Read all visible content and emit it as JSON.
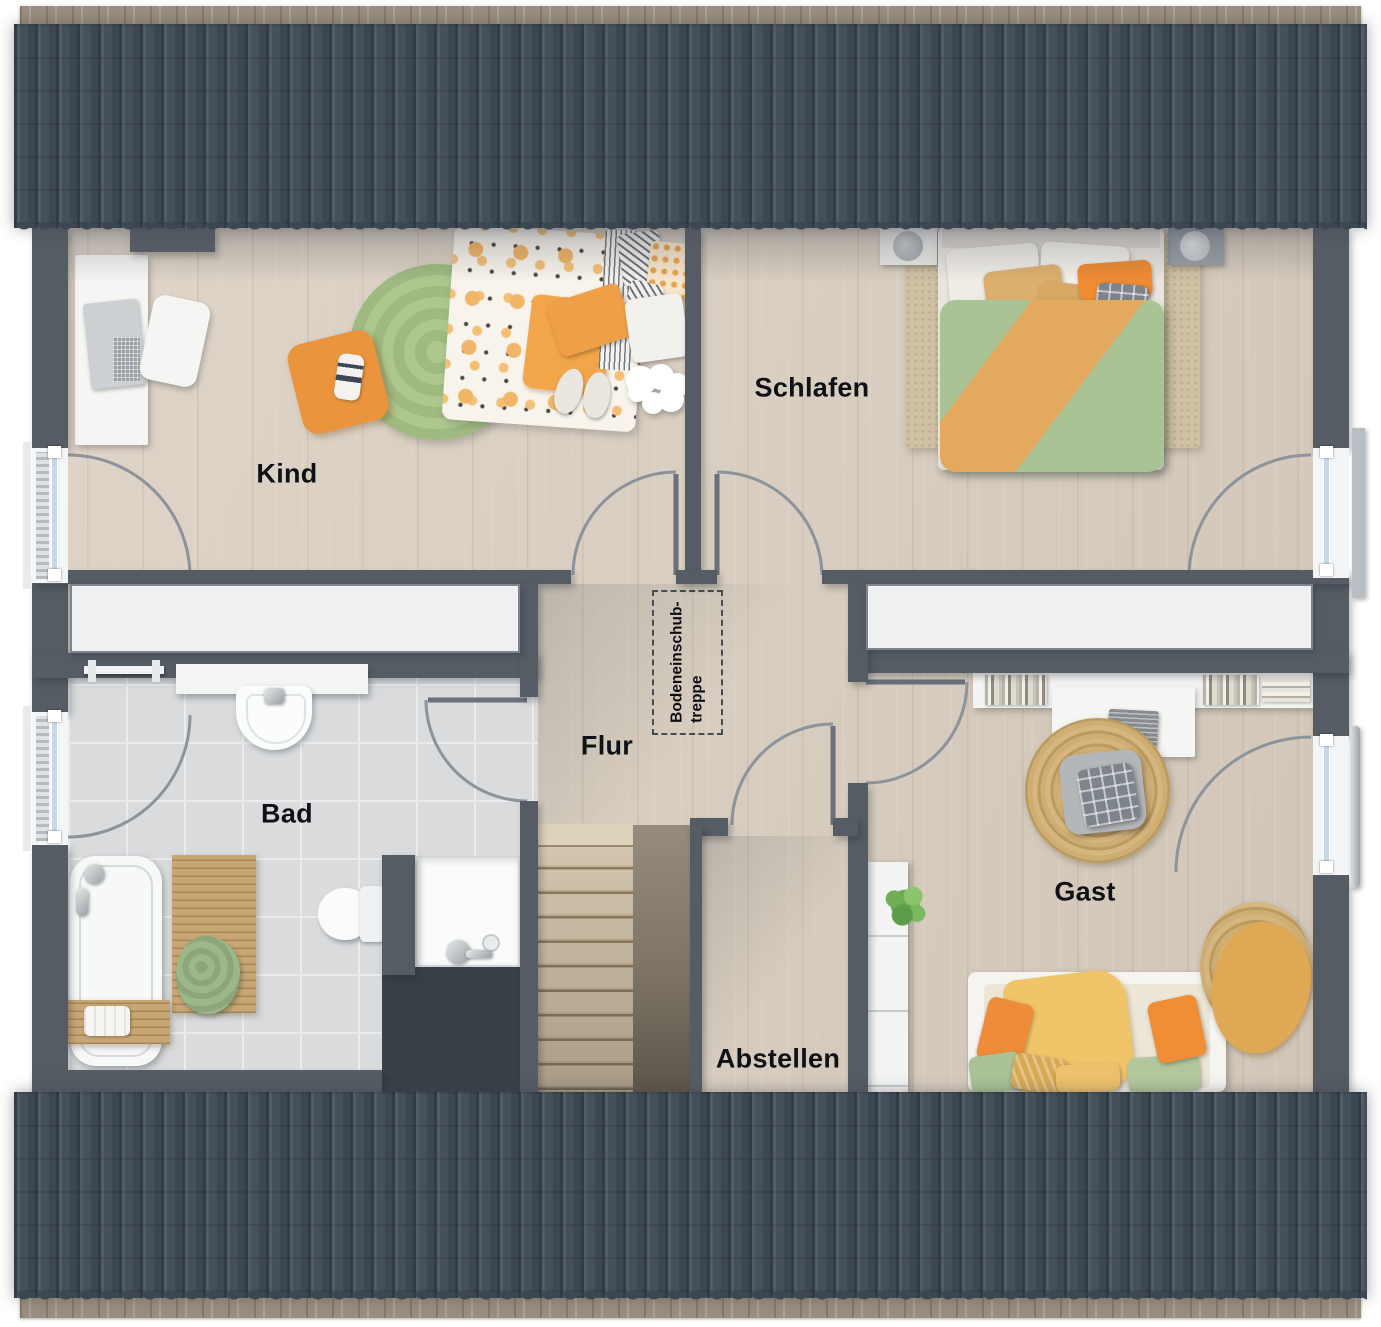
{
  "plan_type": "floorplan-upper-floor",
  "labels": {
    "kind": "Kind",
    "schlafen": "Schlafen",
    "bad": "Bad",
    "flur": "Flur",
    "gast": "Gast",
    "abstellen": "Abstellen"
  },
  "attic_hatch": {
    "line1": "Bodeneinschub-",
    "line2": "treppe"
  },
  "colors": {
    "roof": "#46505b",
    "wall": "#555c64",
    "wood_floor": "#d8cec1",
    "tile_floor": "#d9dbdd",
    "knee_storage": "#eef0f1",
    "accent_orange": "#ea953e",
    "accent_green": "#a9c394",
    "rug_green": "#a8c28d",
    "rug_beige": "#cfc0a3",
    "jute": "#c9a86d",
    "stairs_wood": "#cdbfa9"
  }
}
